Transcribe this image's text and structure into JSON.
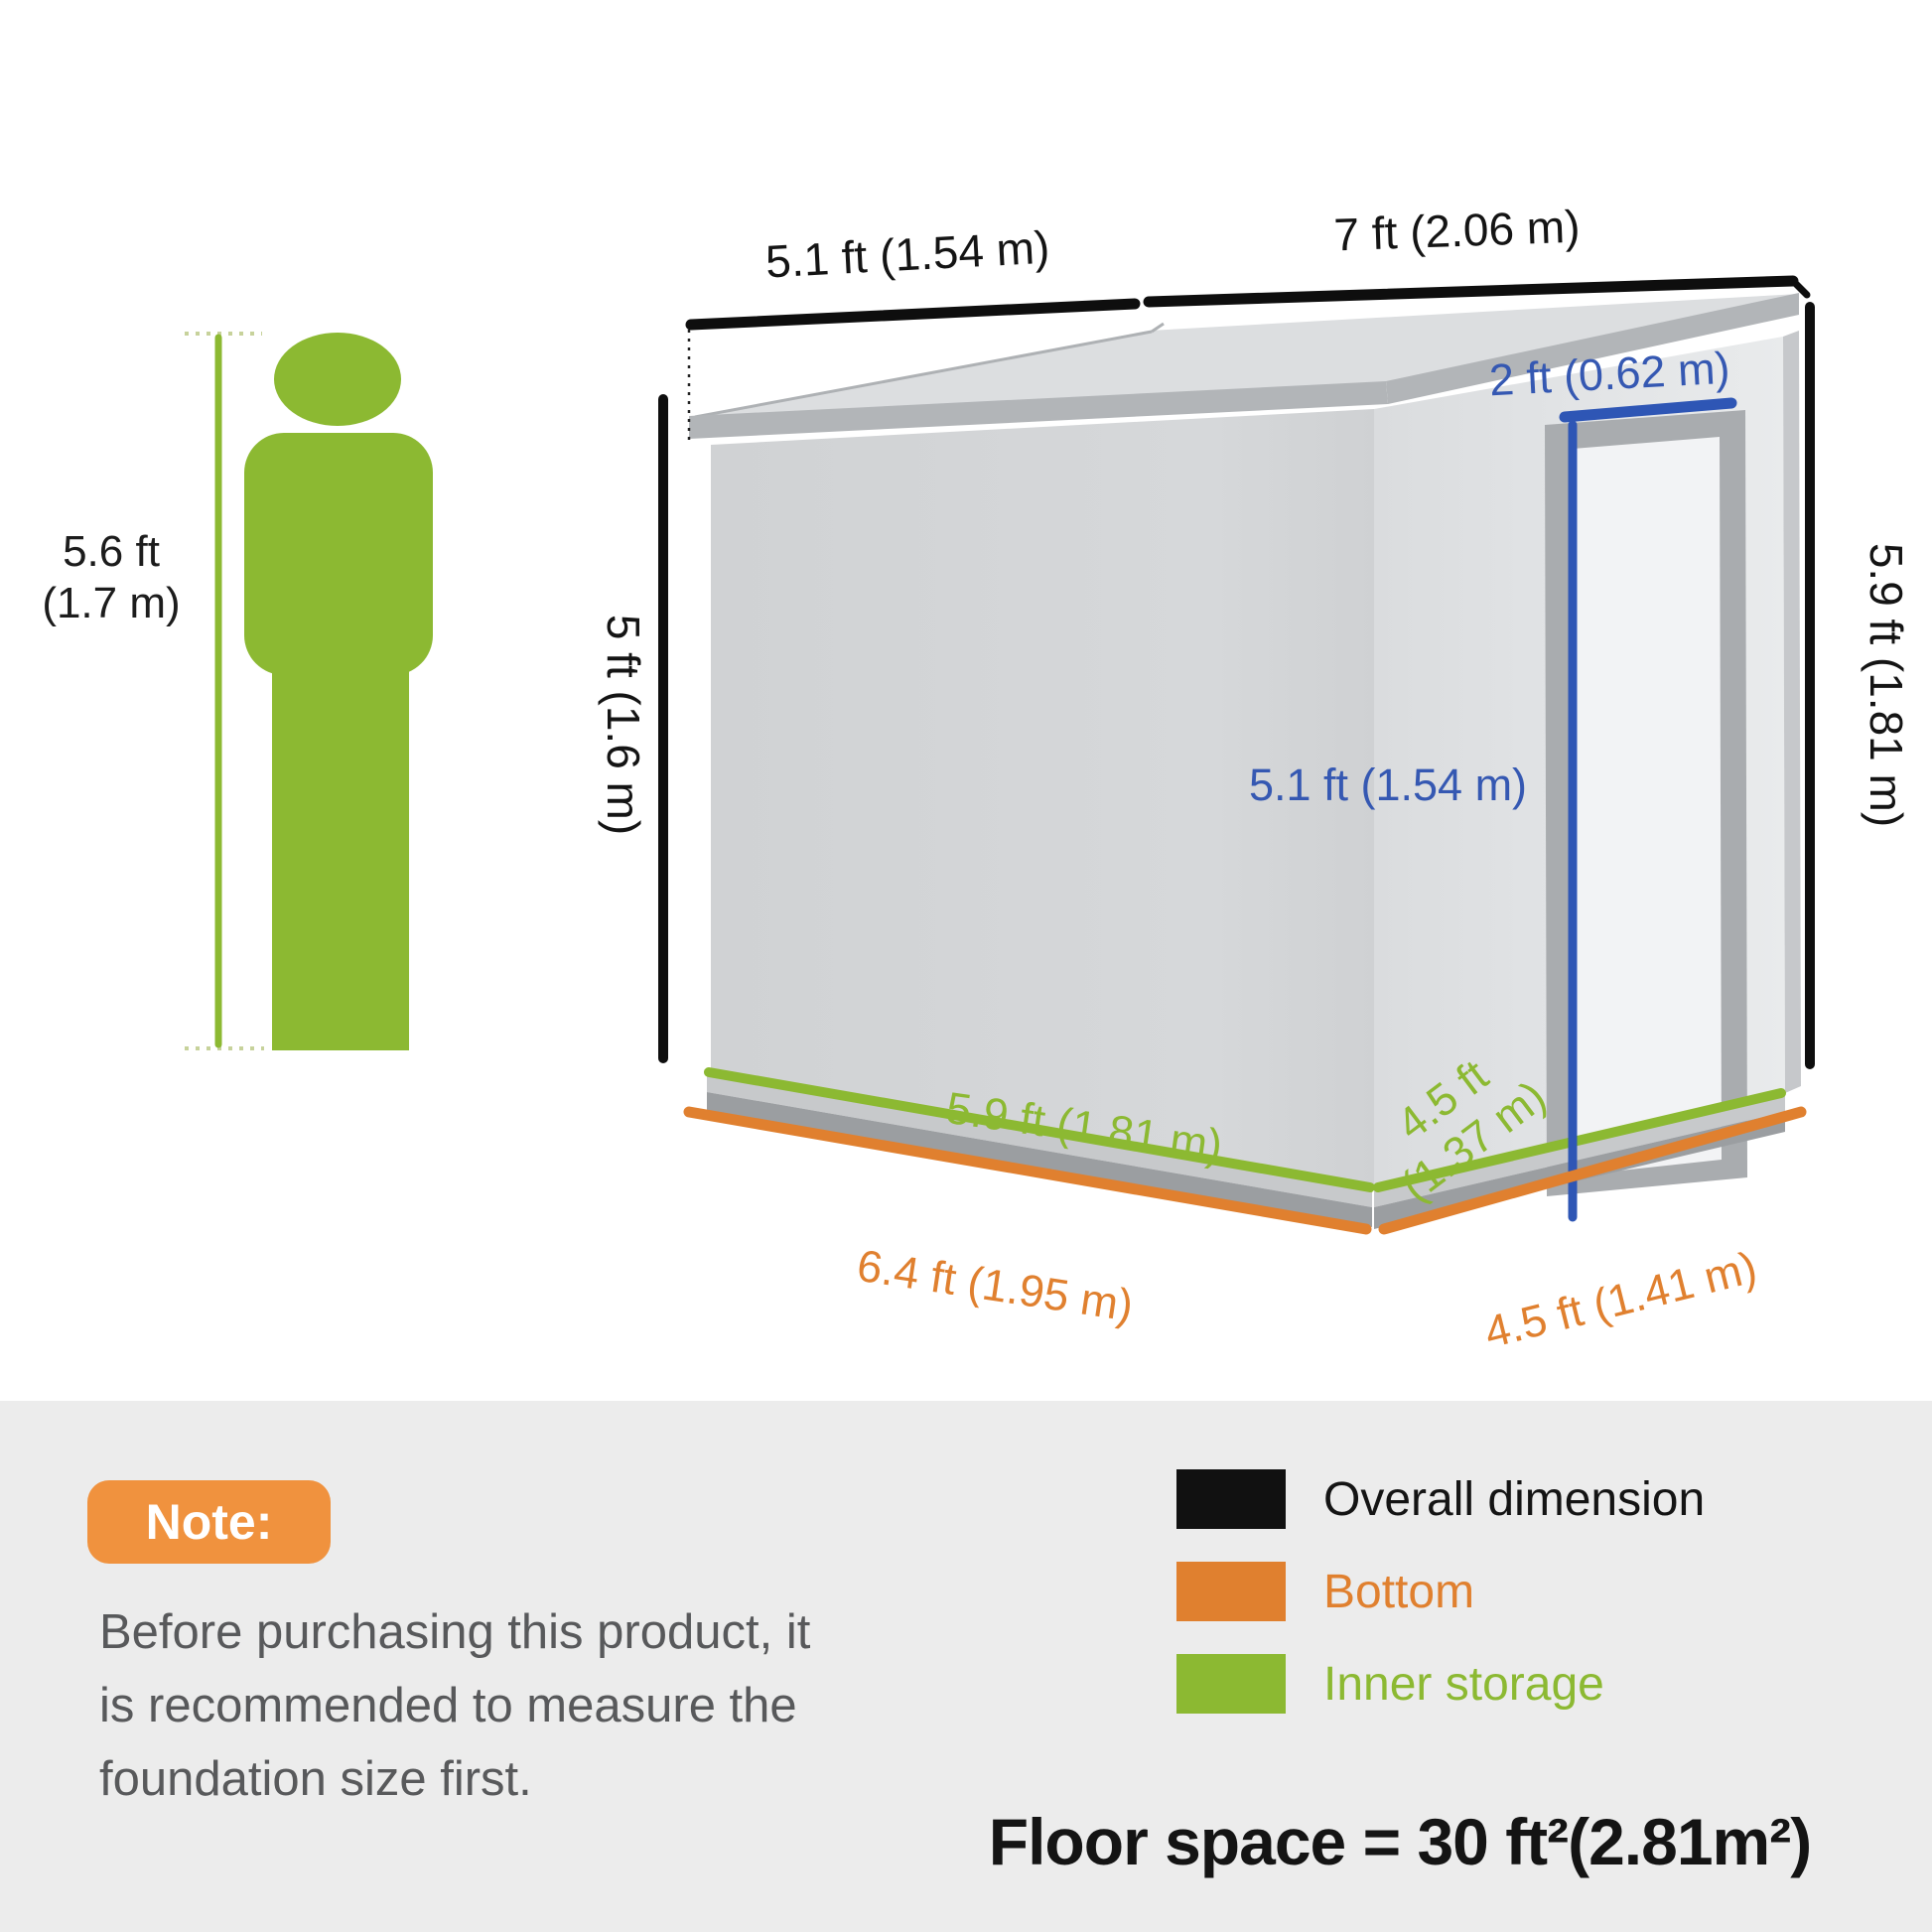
{
  "person": {
    "height_line1": "5.6 ft",
    "height_line2": "(1.7 m)"
  },
  "dimensions": {
    "roof_left": "5.1 ft (1.54 m)",
    "roof_right": "7 ft (2.06 m)",
    "wall_left_height": "5 ft (1.6 m)",
    "wall_right_height": "5.9 ft (1.81 m)",
    "door_width": "2 ft (0.62 m)",
    "door_height": "5.1 ft (1.54 m)",
    "inner_side": "5.9 ft (1.81 m)",
    "inner_front_line1": "4.5 ft",
    "inner_front_line2": "(1.37 m)",
    "bottom_side": "6.4 ft (1.95 m)",
    "bottom_front": "4.5 ft (1.41 m)"
  },
  "note": {
    "badge": "Note:",
    "line1": "Before purchasing this product, it",
    "line2": "is recommended to measure the",
    "line3": "foundation size first."
  },
  "legend": {
    "items": [
      {
        "label": "Overall dimension",
        "color": "#111111"
      },
      {
        "label": "Bottom",
        "color": "#e0802f"
      },
      {
        "label": "Inner storage",
        "color": "#8cb932"
      }
    ]
  },
  "floor_space": "Floor space = 30 ft²(2.81m²)",
  "colors": {
    "green": "#8cb932",
    "orange": "#e0802f",
    "badge_orange": "#f0923e",
    "door_blue": "#2e56b5",
    "blue_text": "#3558b2",
    "dimension_black": "#111111",
    "note_text": "#58595b",
    "section_bg": "#ececec"
  }
}
